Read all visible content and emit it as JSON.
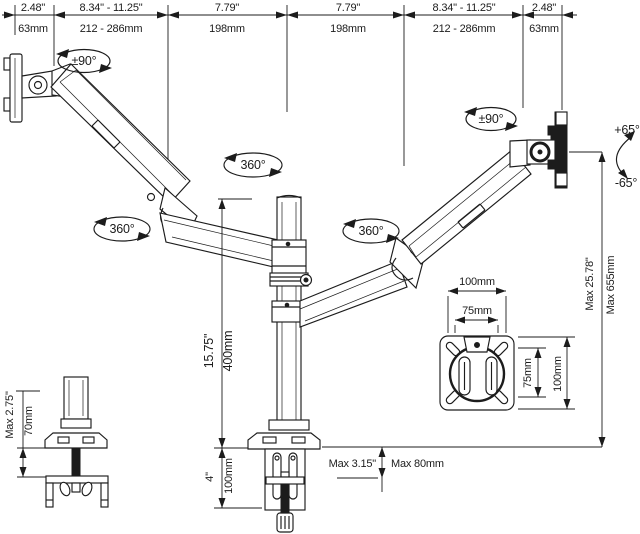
{
  "top_dims": [
    {
      "inch": "2.48\"",
      "mm": "63mm"
    },
    {
      "inch": "8.34\" - 11.25\"",
      "mm": "212 - 286mm"
    },
    {
      "inch": "7.79\"",
      "mm": "198mm"
    },
    {
      "inch": "7.79\"",
      "mm": "198mm"
    },
    {
      "inch": "8.34\" - 11.25\"",
      "mm": "212 - 286mm"
    },
    {
      "inch": "2.48\"",
      "mm": "63mm"
    }
  ],
  "rotation_labels": {
    "left_mount_swivel": "±90°",
    "pole_rotation": "360°",
    "left_arm_rotation": "360°",
    "right_arm_rotation": "360°",
    "right_mount_swivel": "±90°",
    "tilt_up": "+65°",
    "tilt_down": "-65°"
  },
  "vertical_dims": {
    "pole_height_inch": "15.75\"",
    "pole_height_mm": "400mm",
    "clamp_depth_inch": "4\"",
    "clamp_depth_mm": "100mm",
    "max_height_inch": "Max 25.78\"",
    "max_height_mm": "Max 655mm"
  },
  "desk_dims": {
    "clamp_max_inch": "Max 3.15\"",
    "clamp_max_mm": "Max 80mm",
    "grommet_max_inch": "Max 2.75\"",
    "grommet_max_mm": "70mm"
  },
  "vesa_detail": {
    "width_outer": "100mm",
    "width_inner": "75mm",
    "height_inner": "75mm",
    "height_outer": "100mm"
  },
  "colors": {
    "line": "#1c1c1c",
    "background": "#ffffff"
  }
}
